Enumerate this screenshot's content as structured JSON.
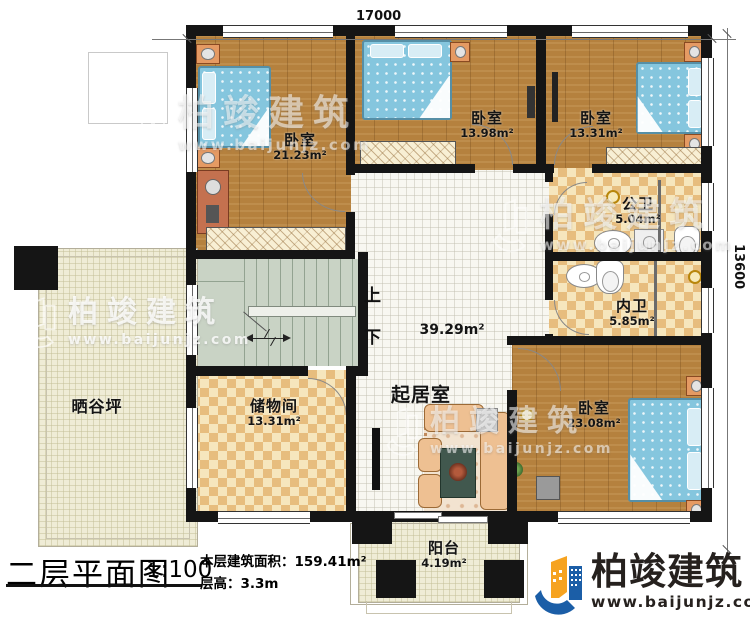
{
  "meta": {
    "title_block": {
      "plan_name": "二层平面图",
      "scale": "1:100",
      "area_label": "本层建筑面积：",
      "area_value": "159.41m²",
      "height_label": "层高：",
      "height_value": "3.3m"
    },
    "dimensions": {
      "top": "17000",
      "right": "13600"
    },
    "stairs": {
      "up": "上",
      "down": "下"
    }
  },
  "rooms": {
    "bedroom1": {
      "name": "卧室",
      "area": "21.23m²"
    },
    "bedroom2": {
      "name": "卧室",
      "area": "13.98m²"
    },
    "bedroom3": {
      "name": "卧室",
      "area": "13.31m²"
    },
    "public_bath": {
      "name": "公卫",
      "area": "5.04m²"
    },
    "ensuite_bath": {
      "name": "内卫",
      "area": "5.85m²"
    },
    "living": {
      "name": "起居室",
      "area": "39.29m²"
    },
    "storage": {
      "name": "储物间",
      "area": "13.31m²"
    },
    "terrace": {
      "name": "晒谷坪"
    },
    "bedroom4": {
      "name": "卧室",
      "area": "23.08m²"
    },
    "balcony": {
      "name": "阳台",
      "area": "4.19m²"
    }
  },
  "branding": {
    "company": "柏竣建筑",
    "website": "www.baijunjz.com"
  },
  "colors": {
    "wall": "#151515",
    "wood_floor": "#b5813e",
    "tile_light": "#f6e6bd",
    "tile_dark": "#e7bd7e",
    "deck": "#efecd6",
    "living_floor": "#f8f7f1",
    "stairs": "#c9d3c5",
    "bed": "#85c6de",
    "logo_blue": "#1b5ea7",
    "logo_orange": "#f6a320",
    "ink": "#111111"
  }
}
